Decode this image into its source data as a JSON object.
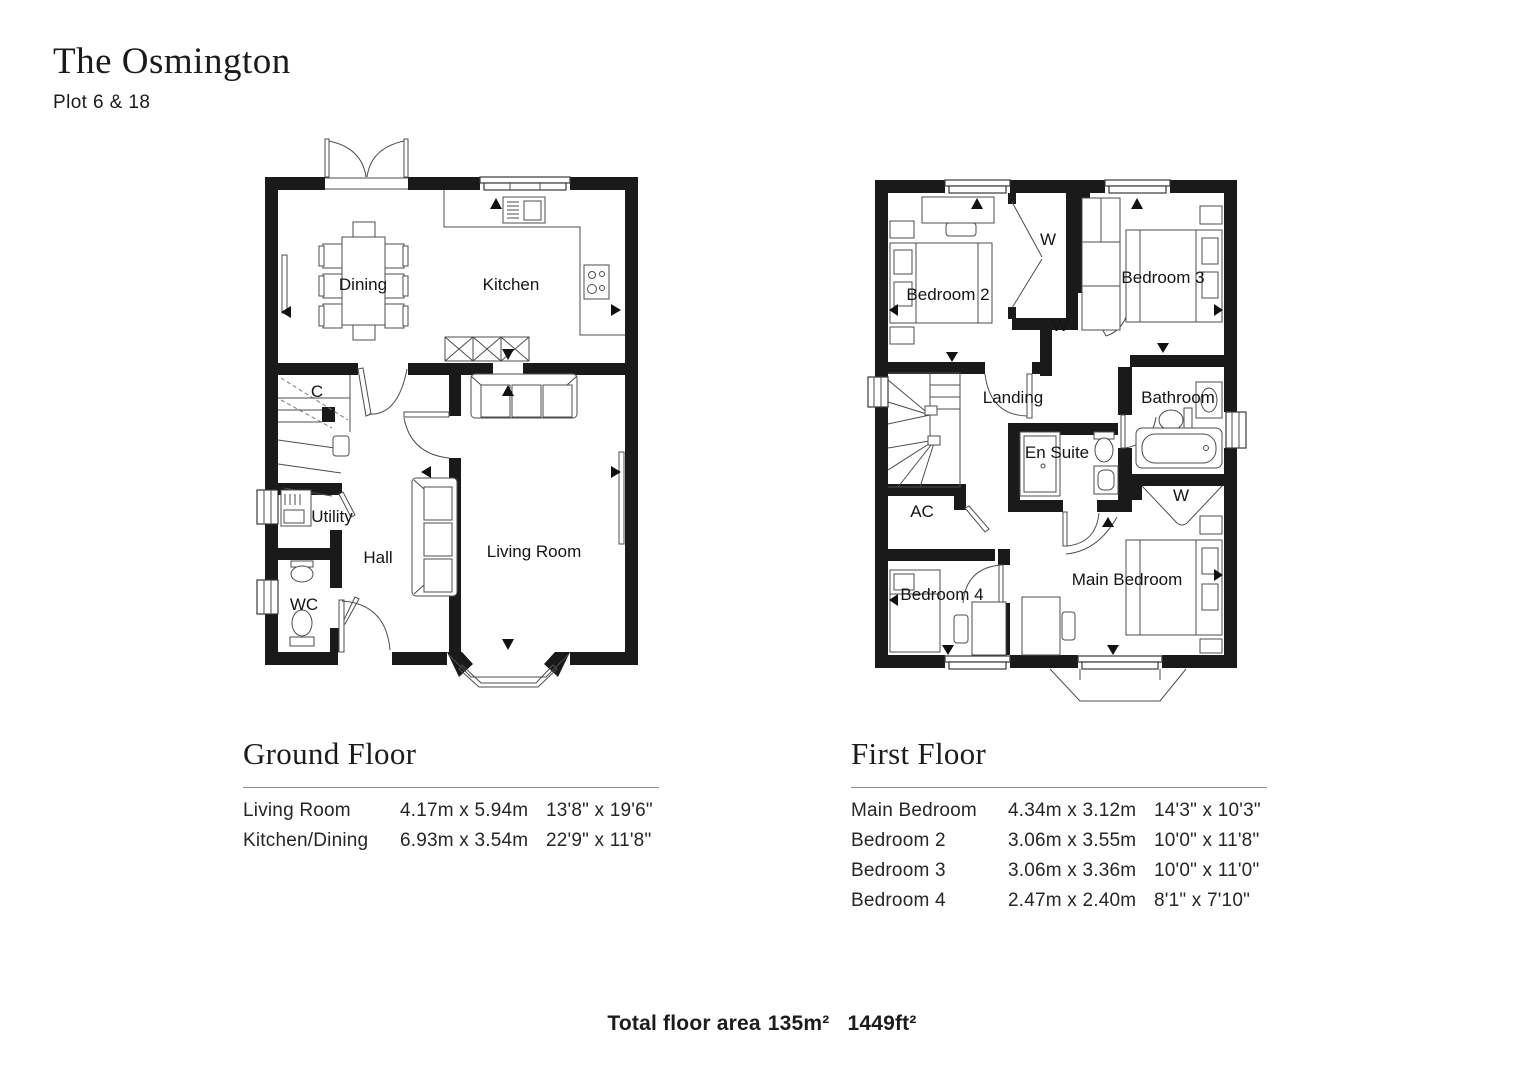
{
  "header": {
    "title": "The Osmington",
    "subtitle": "Plot 6 & 18"
  },
  "ground_floor": {
    "heading": "Ground Floor",
    "plan_labels": {
      "dining": "Dining",
      "kitchen": "Kitchen",
      "cupboard": "C",
      "utility": "Utility",
      "hall": "Hall",
      "wc": "WC",
      "living_room": "Living Room"
    },
    "table": {
      "rows": [
        {
          "room": "Living Room",
          "metric": "4.17m x 5.94m",
          "imperial": "13'8\" x 19'6\""
        },
        {
          "room": "Kitchen/Dining",
          "metric": "6.93m x 3.54m",
          "imperial": "22'9\" x 11'8\""
        }
      ]
    }
  },
  "first_floor": {
    "heading": "First Floor",
    "plan_labels": {
      "bedroom2": "Bedroom 2",
      "bedroom3": "Bedroom 3",
      "wardrobe": "W",
      "landing": "Landing",
      "bathroom": "Bathroom",
      "en_suite": "En Suite",
      "ac": "AC",
      "bedroom4": "Bedroom 4",
      "main_bedroom": "Main Bedroom"
    },
    "table": {
      "rows": [
        {
          "room": "Main Bedroom",
          "metric": "4.34m x 3.12m",
          "imperial": "14'3\" x 10'3\""
        },
        {
          "room": "Bedroom 2",
          "metric": "3.06m x 3.55m",
          "imperial": "10'0\" x 11'8\""
        },
        {
          "room": "Bedroom 3",
          "metric": "3.06m x 3.36m",
          "imperial": "10'0\" x 11'0\""
        },
        {
          "room": "Bedroom 4",
          "metric": "2.47m x 2.40m",
          "imperial": "8'1\" x 7'10\""
        }
      ]
    }
  },
  "footer": {
    "label": "Total floor area",
    "metric": "135m²",
    "imperial": "1449ft²"
  }
}
